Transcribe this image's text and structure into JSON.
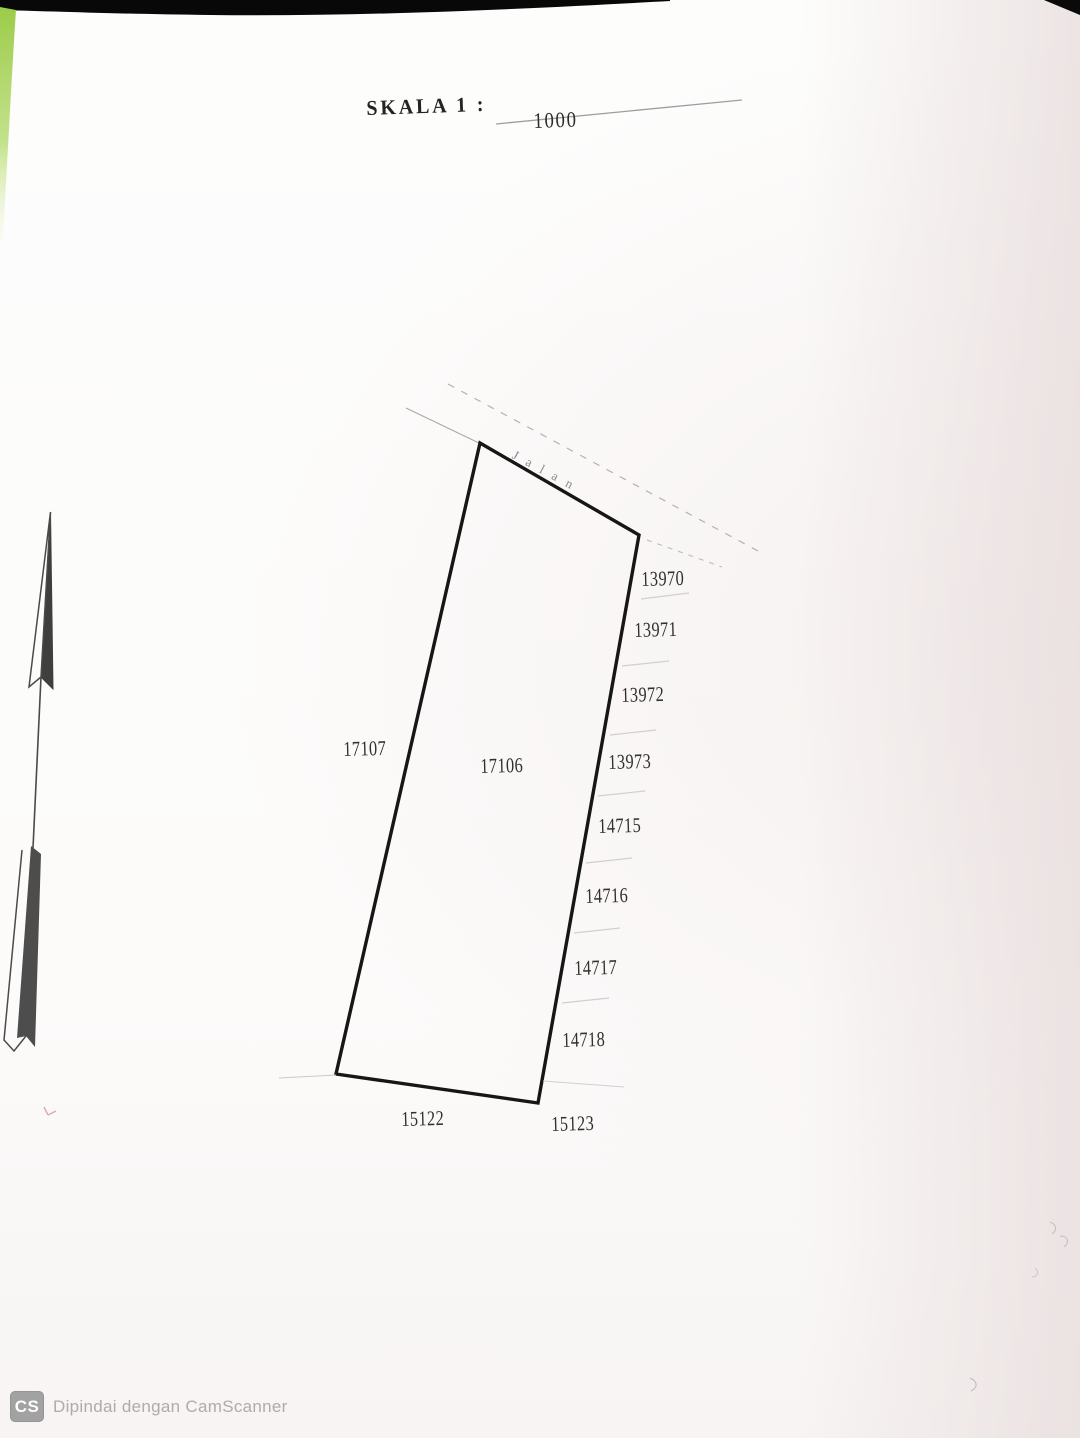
{
  "title": {
    "label": "SKALA 1 :",
    "value": "1000"
  },
  "map": {
    "road_label": "Jalan",
    "parcel_main": "17106",
    "parcel_left": "17107",
    "parcels_right": [
      "13970",
      "13971",
      "13972",
      "13973",
      "14715",
      "14716",
      "14717",
      "14718"
    ],
    "parcels_bottom": [
      "15122",
      "15123"
    ]
  },
  "footer": {
    "badge_label": "CS",
    "scan_attribution": "Dipindai dengan CamScanner"
  },
  "colors": {
    "ink": "#161616",
    "paper": "#fcfbfa",
    "paper_shade_right": "#eee4e4",
    "scan_edge_black": "#080808",
    "scan_corner_green": "#a3d153",
    "footer_gray": "#acacac",
    "faint_line_gray": "#c9c9c9",
    "red_mark": "#a8495f"
  }
}
